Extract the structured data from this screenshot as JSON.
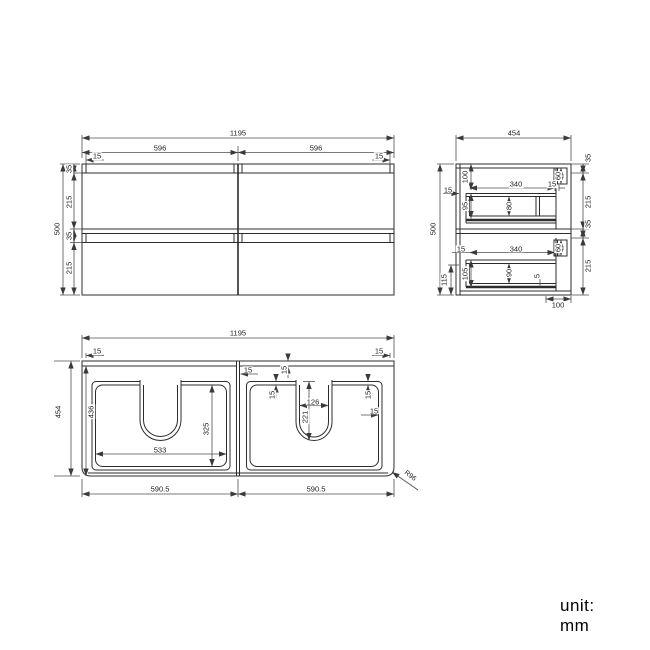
{
  "front_view": {
    "total_width": "1195",
    "half_left": "596",
    "half_right": "596",
    "edge_left": "15",
    "edge_right": "15",
    "height_total": "500",
    "seg_top_rail": "35",
    "seg_drawer1": "215",
    "seg_mid_rail": "35",
    "seg_drawer2": "215"
  },
  "side_view": {
    "total_depth": "454",
    "height_total": "500",
    "seg_top": "35",
    "seg_drawer1": "215",
    "seg_mid": "35",
    "seg_drawer2": "215",
    "top_drawer": {
      "top_offset": "100",
      "back_gap": "15",
      "box_depth": "95",
      "inner_width": "340",
      "front_gap": "15",
      "inner_height": "80",
      "handle_recess": "60"
    },
    "bottom_drawer": {
      "handle_recess": "60",
      "inner_width": "340",
      "back_gap": "15",
      "box_depth": "105",
      "inner_height": "90",
      "bottom_gap": "5",
      "bottom_offset": "115"
    },
    "bottom_depth": "100"
  },
  "plan_view": {
    "total_width": "1195",
    "edge_left": "15",
    "edge_right": "15",
    "depth_total": "454",
    "depth_inner": "436",
    "divider_gap": "15",
    "front_rail": "15",
    "cutout_gap_left": "15",
    "cutout_width": "126",
    "cutout_depth": "221",
    "cutout_gap_right": "15",
    "side_wall": "15",
    "basin_width": "533",
    "basin_depth": "325",
    "bottom_half_left": "590.5",
    "bottom_half_right": "590.5",
    "corner_radius": "R96"
  },
  "footer": {
    "unit_label": "unit: mm"
  }
}
